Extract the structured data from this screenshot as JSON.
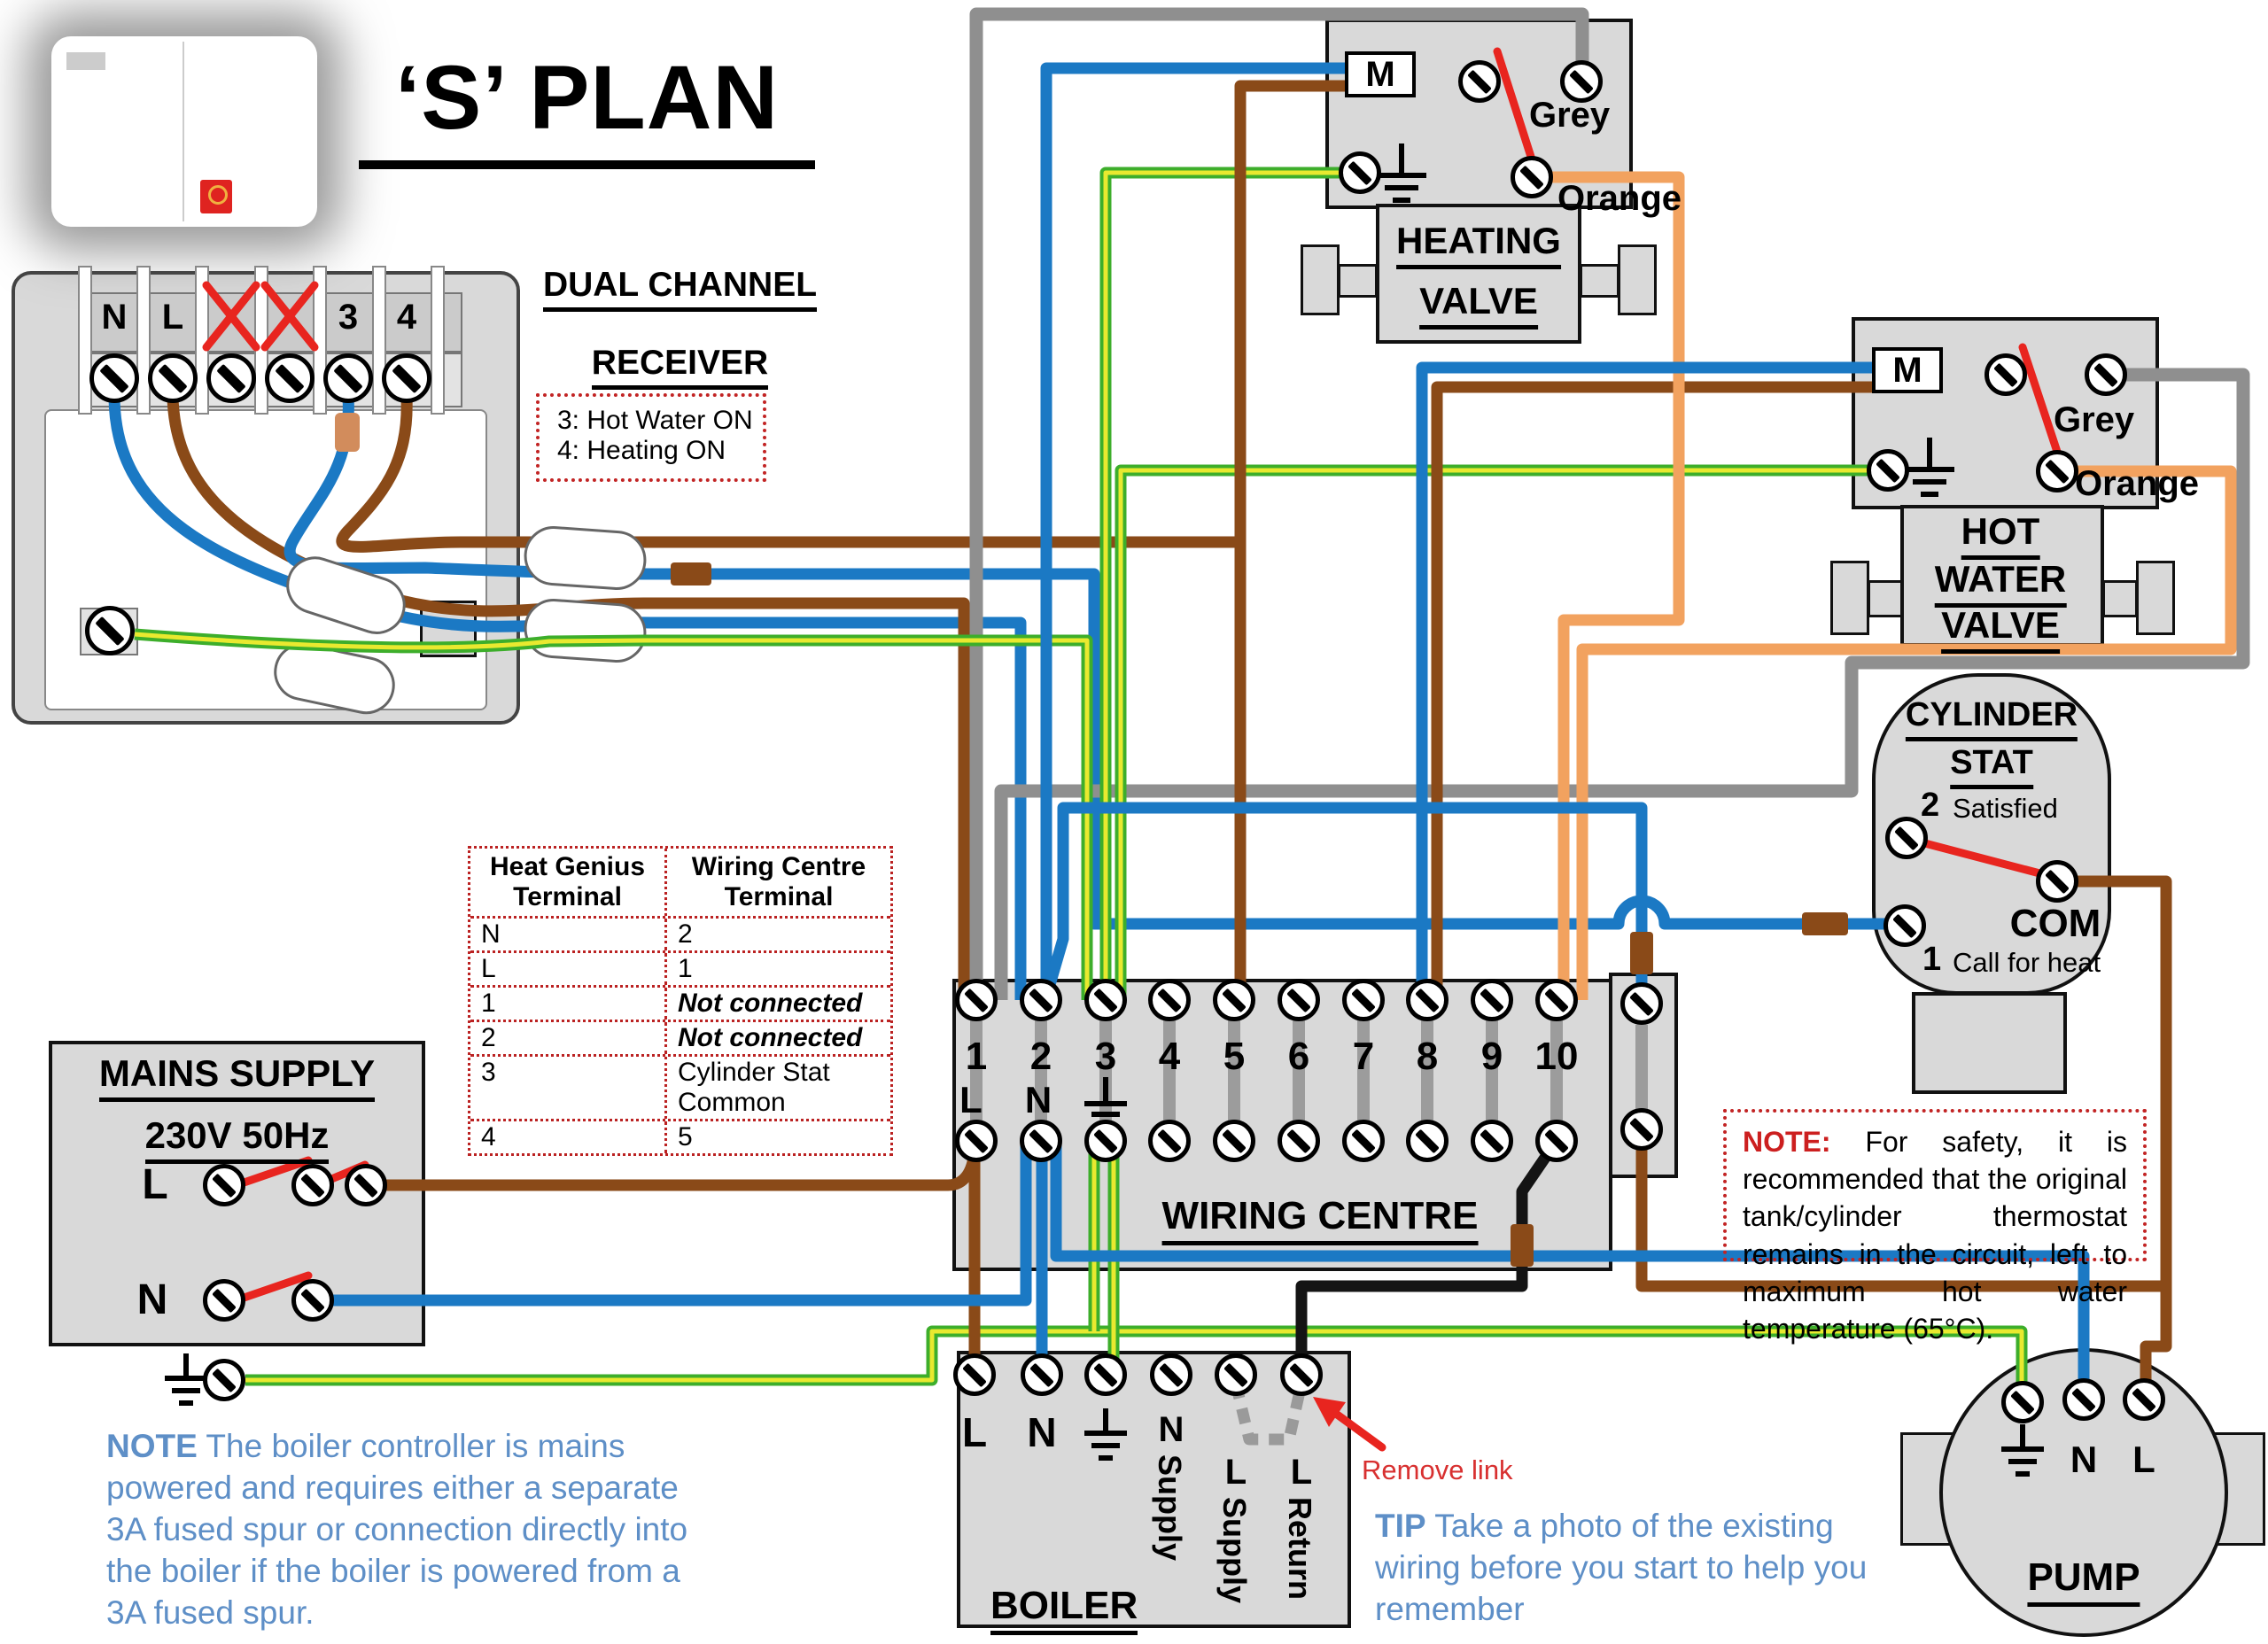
{
  "title": "‘S’ PLAN",
  "receiver": {
    "heading1": "DUAL CHANNEL",
    "heading2": "RECEIVER",
    "t_n": "N",
    "t_l": "L",
    "t_3": "3",
    "t_4": "4",
    "legend1": "3: Hot Water ON",
    "legend2": "4: Heating ON"
  },
  "heating_valve": {
    "motor": "M",
    "grey": "Grey",
    "orange": "Orange",
    "title1": "HEATING",
    "title2": "VALVE"
  },
  "hot_water_valve": {
    "motor": "M",
    "grey": "Grey",
    "orange": "Orange",
    "title1": "HOT",
    "title2": "WATER",
    "title3": "VALVE"
  },
  "cylinder_stat": {
    "title1": "CYLINDER",
    "title2": "STAT",
    "num2": "2",
    "satisfied": "Satisfied",
    "com": "COM",
    "num1": "1",
    "call": "Call for heat"
  },
  "table": {
    "head1": "Heat Genius Terminal",
    "head2": "Wiring Centre Terminal",
    "rows": [
      [
        "N",
        "2"
      ],
      [
        "L",
        "1"
      ],
      [
        "1",
        "Not connected"
      ],
      [
        "2",
        "Not connected"
      ],
      [
        "3",
        "Cylinder Stat Common"
      ],
      [
        "4",
        "5"
      ]
    ]
  },
  "mains": {
    "title": "MAINS SUPPLY",
    "subtitle": "230V 50Hz",
    "l": "L",
    "n": "N"
  },
  "wiring_centre": {
    "title": "WIRING CENTRE",
    "l": "L",
    "n": "N",
    "nums": [
      "1",
      "2",
      "3",
      "4",
      "5",
      "6",
      "7",
      "8",
      "9",
      "10"
    ]
  },
  "boiler": {
    "title": "BOILER",
    "l": "L",
    "n": "N",
    "v1l": "N",
    "v1w": "Supply",
    "v2l": "L",
    "v2w": "Supply",
    "v3l": "L",
    "v3w": "Return",
    "remove": "Remove link"
  },
  "pump": {
    "title": "PUMP",
    "n": "N",
    "l": "L"
  },
  "notes": {
    "safety_label": "NOTE:",
    "safety_text": "For safety, it is recommended that the original tank/cylinder thermostat remains in the circuit, left to maximum hot water temperature (65°C).",
    "boiler_label": "NOTE",
    "boiler_text": "The boiler controller is mains powered and requires either a separate 3A fused spur or connection directly into the boiler if the boiler is powered from a 3A fused spur.",
    "tip_label": "TIP",
    "tip_text": "Take a photo of the existing wiring before you start to help you remember"
  },
  "colors": {
    "blue": "#1b79c4",
    "brown": "#8a4a18",
    "grey": "#8f8f8f",
    "green": "#3dae2b",
    "yellow": "#e9e92f",
    "orange": "#f2a25f",
    "black": "#141414",
    "red": "#e8251f",
    "box": "#d9d9d9"
  }
}
